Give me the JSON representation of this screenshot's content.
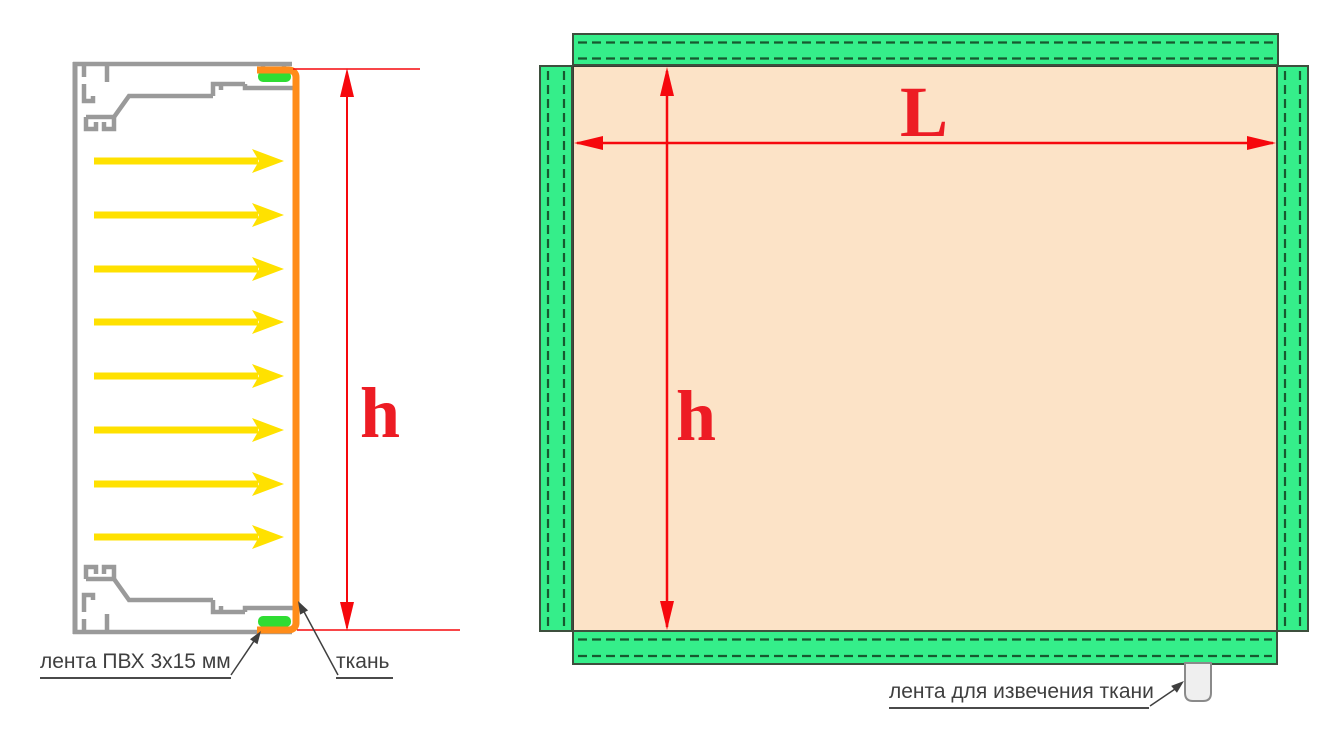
{
  "left_view": {
    "title_semantic": "profile-cross-section",
    "pvc_tape_label": "лента ПВХ 3x15 мм",
    "fabric_label": "ткань",
    "height_dim_label": "h",
    "fabric_arrow_count": 8
  },
  "right_view": {
    "title_semantic": "fabric-panel-front-view",
    "width_dim_label": "L",
    "height_dim_label": "h",
    "pull_tape_label": "лента для извечения ткани"
  },
  "colors": {
    "profile_gray": "#9a9a9a",
    "fabric_orange": "#ff8c19",
    "tape_green": "#2fdd33",
    "arrow_yellow": "#ffe100",
    "dimension_red": "#f6080d",
    "dim_letter_red": "#ed1c24",
    "edge_strip_green": "#35ee8a",
    "stitch_dark_green": "#17592f",
    "fabric_peach": "#fce3c7",
    "strip_outline": "#3d4f3d",
    "pull_tab_fill": "#efefef",
    "pull_tab_stroke": "#8a8a8a",
    "callout_text": "#3f3f3f"
  }
}
